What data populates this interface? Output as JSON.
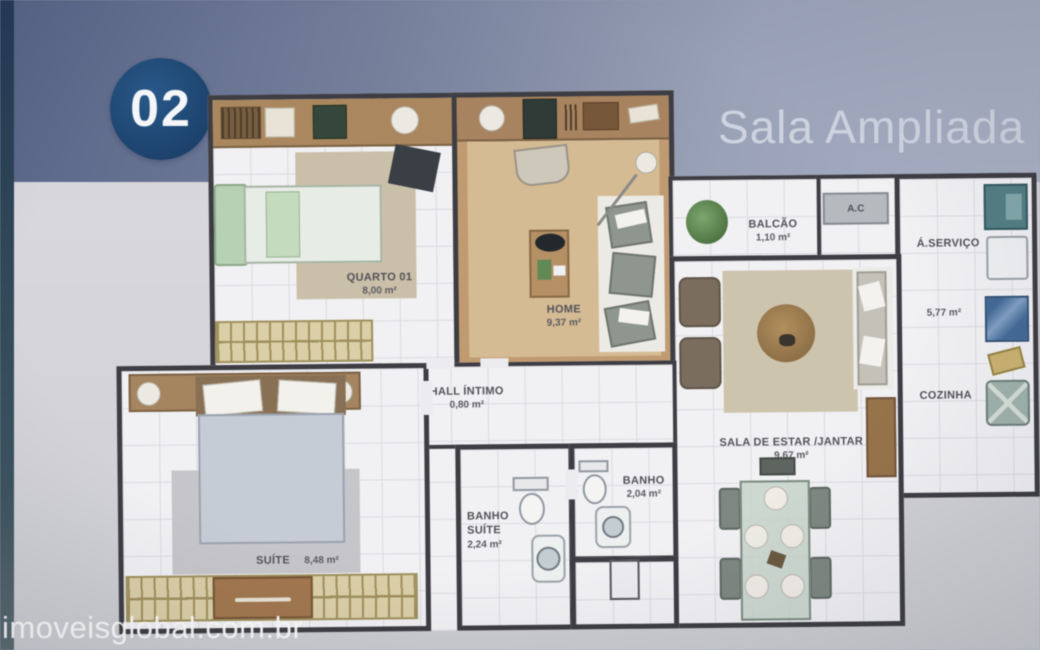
{
  "page": {
    "badge": "02",
    "title": "Sala Ampliada",
    "watermark": "imoveisglobal.com.br"
  },
  "colors": {
    "band_start": "#56648c",
    "band_end": "#a9b0c6",
    "badge_bg": "#1b4c80",
    "wall": "#3d3d44",
    "tile_floor": "#f1f1f4",
    "wood_floor": "#c49a6c",
    "label_text": "#515159"
  },
  "rooms": {
    "quarto01": {
      "name": "QUARTO 01",
      "area": "8,00 m²"
    },
    "home": {
      "name": "HOME",
      "area": "9,37 m²"
    },
    "balcao": {
      "name": "BALCÃO",
      "area": "1,10 m²"
    },
    "ac": {
      "name": "A.C"
    },
    "servico": {
      "name": "Á.SERVIÇO"
    },
    "cozinha": {
      "name": "COZINHA",
      "area": "5,77 m²"
    },
    "sala": {
      "name": "SALA DE ESTAR /JANTAR",
      "area": "9,67 m²"
    },
    "hall": {
      "name": "HALL ÍNTIMO",
      "area": "0,80 m²"
    },
    "suite": {
      "name": "SUÍTE",
      "area": "8,48 m²"
    },
    "banho_suite": {
      "name": "BANHO SUÍTE",
      "area": "2,24 m²"
    },
    "banho": {
      "name": "BANHO",
      "area": "2,04 m²"
    }
  }
}
